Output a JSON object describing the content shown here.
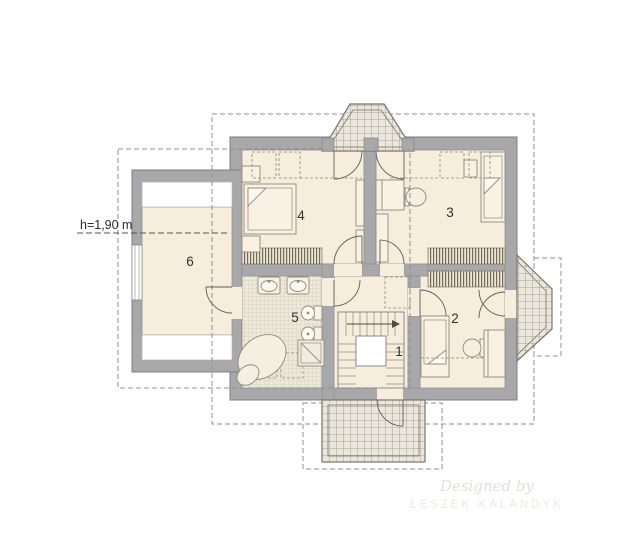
{
  "plan": {
    "labels": {
      "height_note": "h=1,90 m"
    },
    "rooms": [
      {
        "number": "1"
      },
      {
        "number": "2"
      },
      {
        "number": "3"
      },
      {
        "number": "4"
      },
      {
        "number": "5"
      },
      {
        "number": "6"
      }
    ],
    "watermark": {
      "line1": "Designed by",
      "line2": "LESZEK KALANDYK"
    }
  }
}
